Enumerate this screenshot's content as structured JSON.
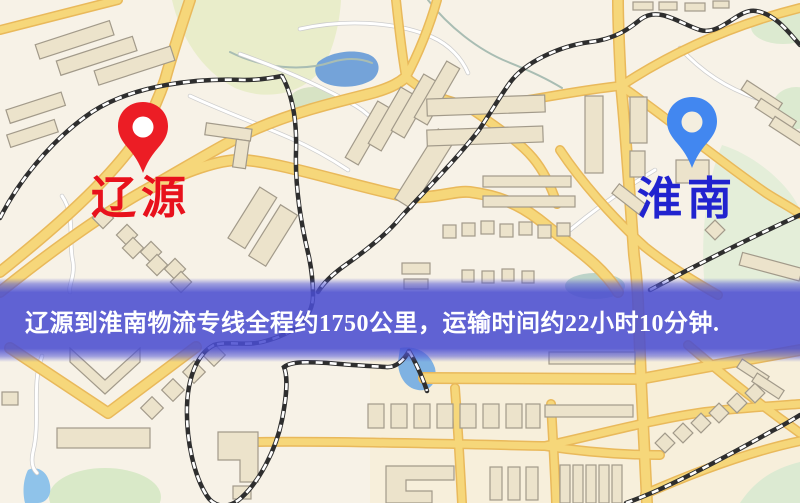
{
  "image": {
    "width": 800,
    "height": 503,
    "kind": "logistics-route-map"
  },
  "markers": {
    "origin": {
      "label": "辽源",
      "pin_color": "#ec1d25",
      "pin_hole_color": "#ffffff",
      "label_color": "#e8111c"
    },
    "destination": {
      "label": "淮南",
      "pin_color": "#4287f0",
      "pin_hole_color": "#f4eedf",
      "label_color": "#2123cf"
    }
  },
  "banner": {
    "text": "辽源到淮南物流专线全程约1750公里，运输时间约22小时10分钟.",
    "text_color": "#ffffff",
    "background_color": "#4a4dd0"
  },
  "map_colors": {
    "base": "#f7f2e7",
    "road_fill": "#f6d77a",
    "road_casing": "#e9b95b",
    "minor_road": "#ffffff",
    "minor_road_casing": "#cccccc",
    "river": "#a9bdb3",
    "park": "#e9edca",
    "park_dark": "#dcead0",
    "water": "#74a3d9",
    "building_fill": "#ece3cb",
    "building_stroke": "#a29a8a",
    "railway_dark": "#2e2e2e",
    "railway_light": "#ffffff"
  }
}
